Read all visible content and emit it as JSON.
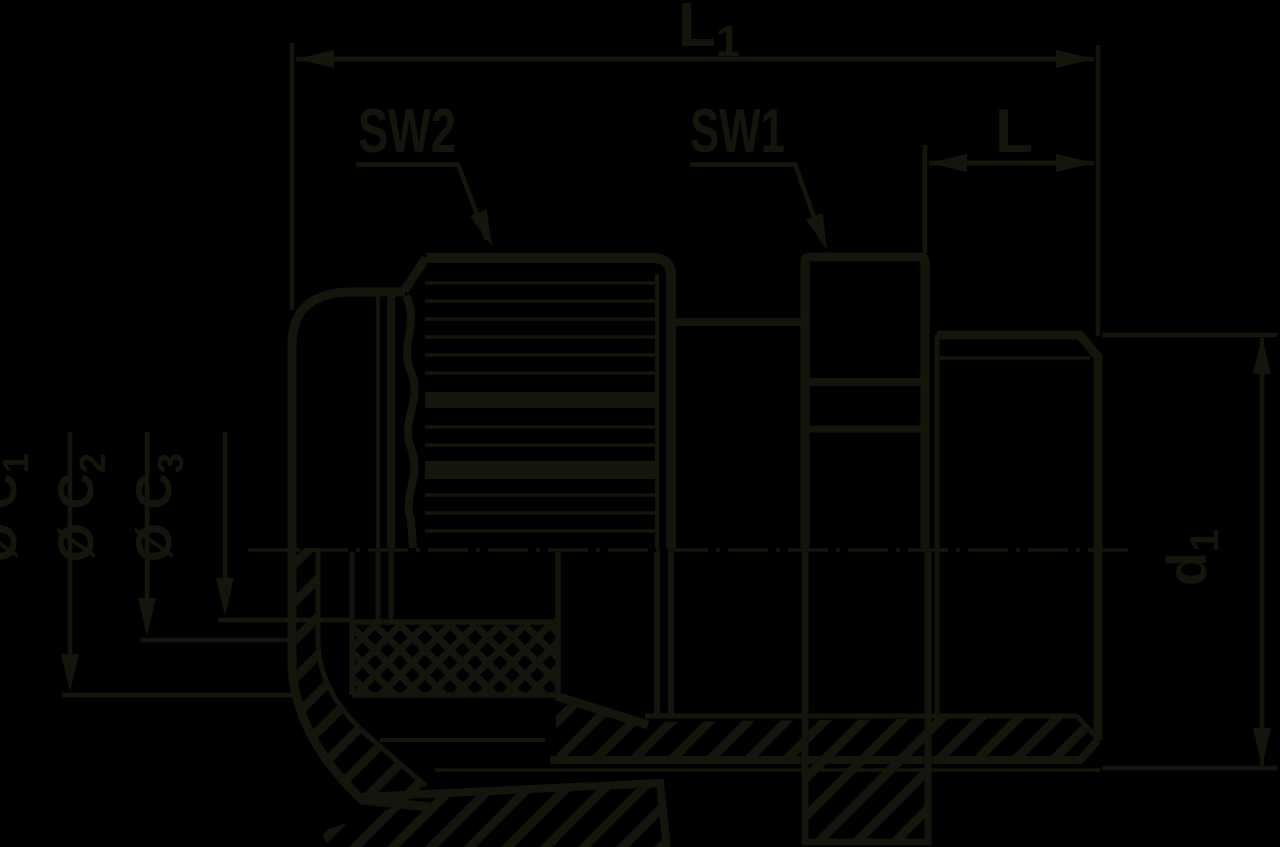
{
  "colors": {
    "background": "#000000",
    "ink": "#15150c"
  },
  "drawing": {
    "kind": "technical line drawing, cross-section of a cable gland fitting",
    "visible_dimension_labels": [
      "L1",
      "SW2",
      "SW1",
      "L",
      "ØC1",
      "ØC2",
      "ØC3",
      "d1"
    ]
  },
  "labels": {
    "l1": {
      "main": "L",
      "sub": "1"
    },
    "l": {
      "main": "L"
    },
    "sw2": {
      "text": "SW2"
    },
    "sw1": {
      "text": "SW1"
    },
    "c1": {
      "prefix": "Ø C",
      "sub": "1"
    },
    "c2": {
      "prefix": "Ø C",
      "sub": "2"
    },
    "c3": {
      "prefix": "Ø C",
      "sub": "3"
    },
    "d1": {
      "main": "d",
      "sub": "1"
    }
  }
}
